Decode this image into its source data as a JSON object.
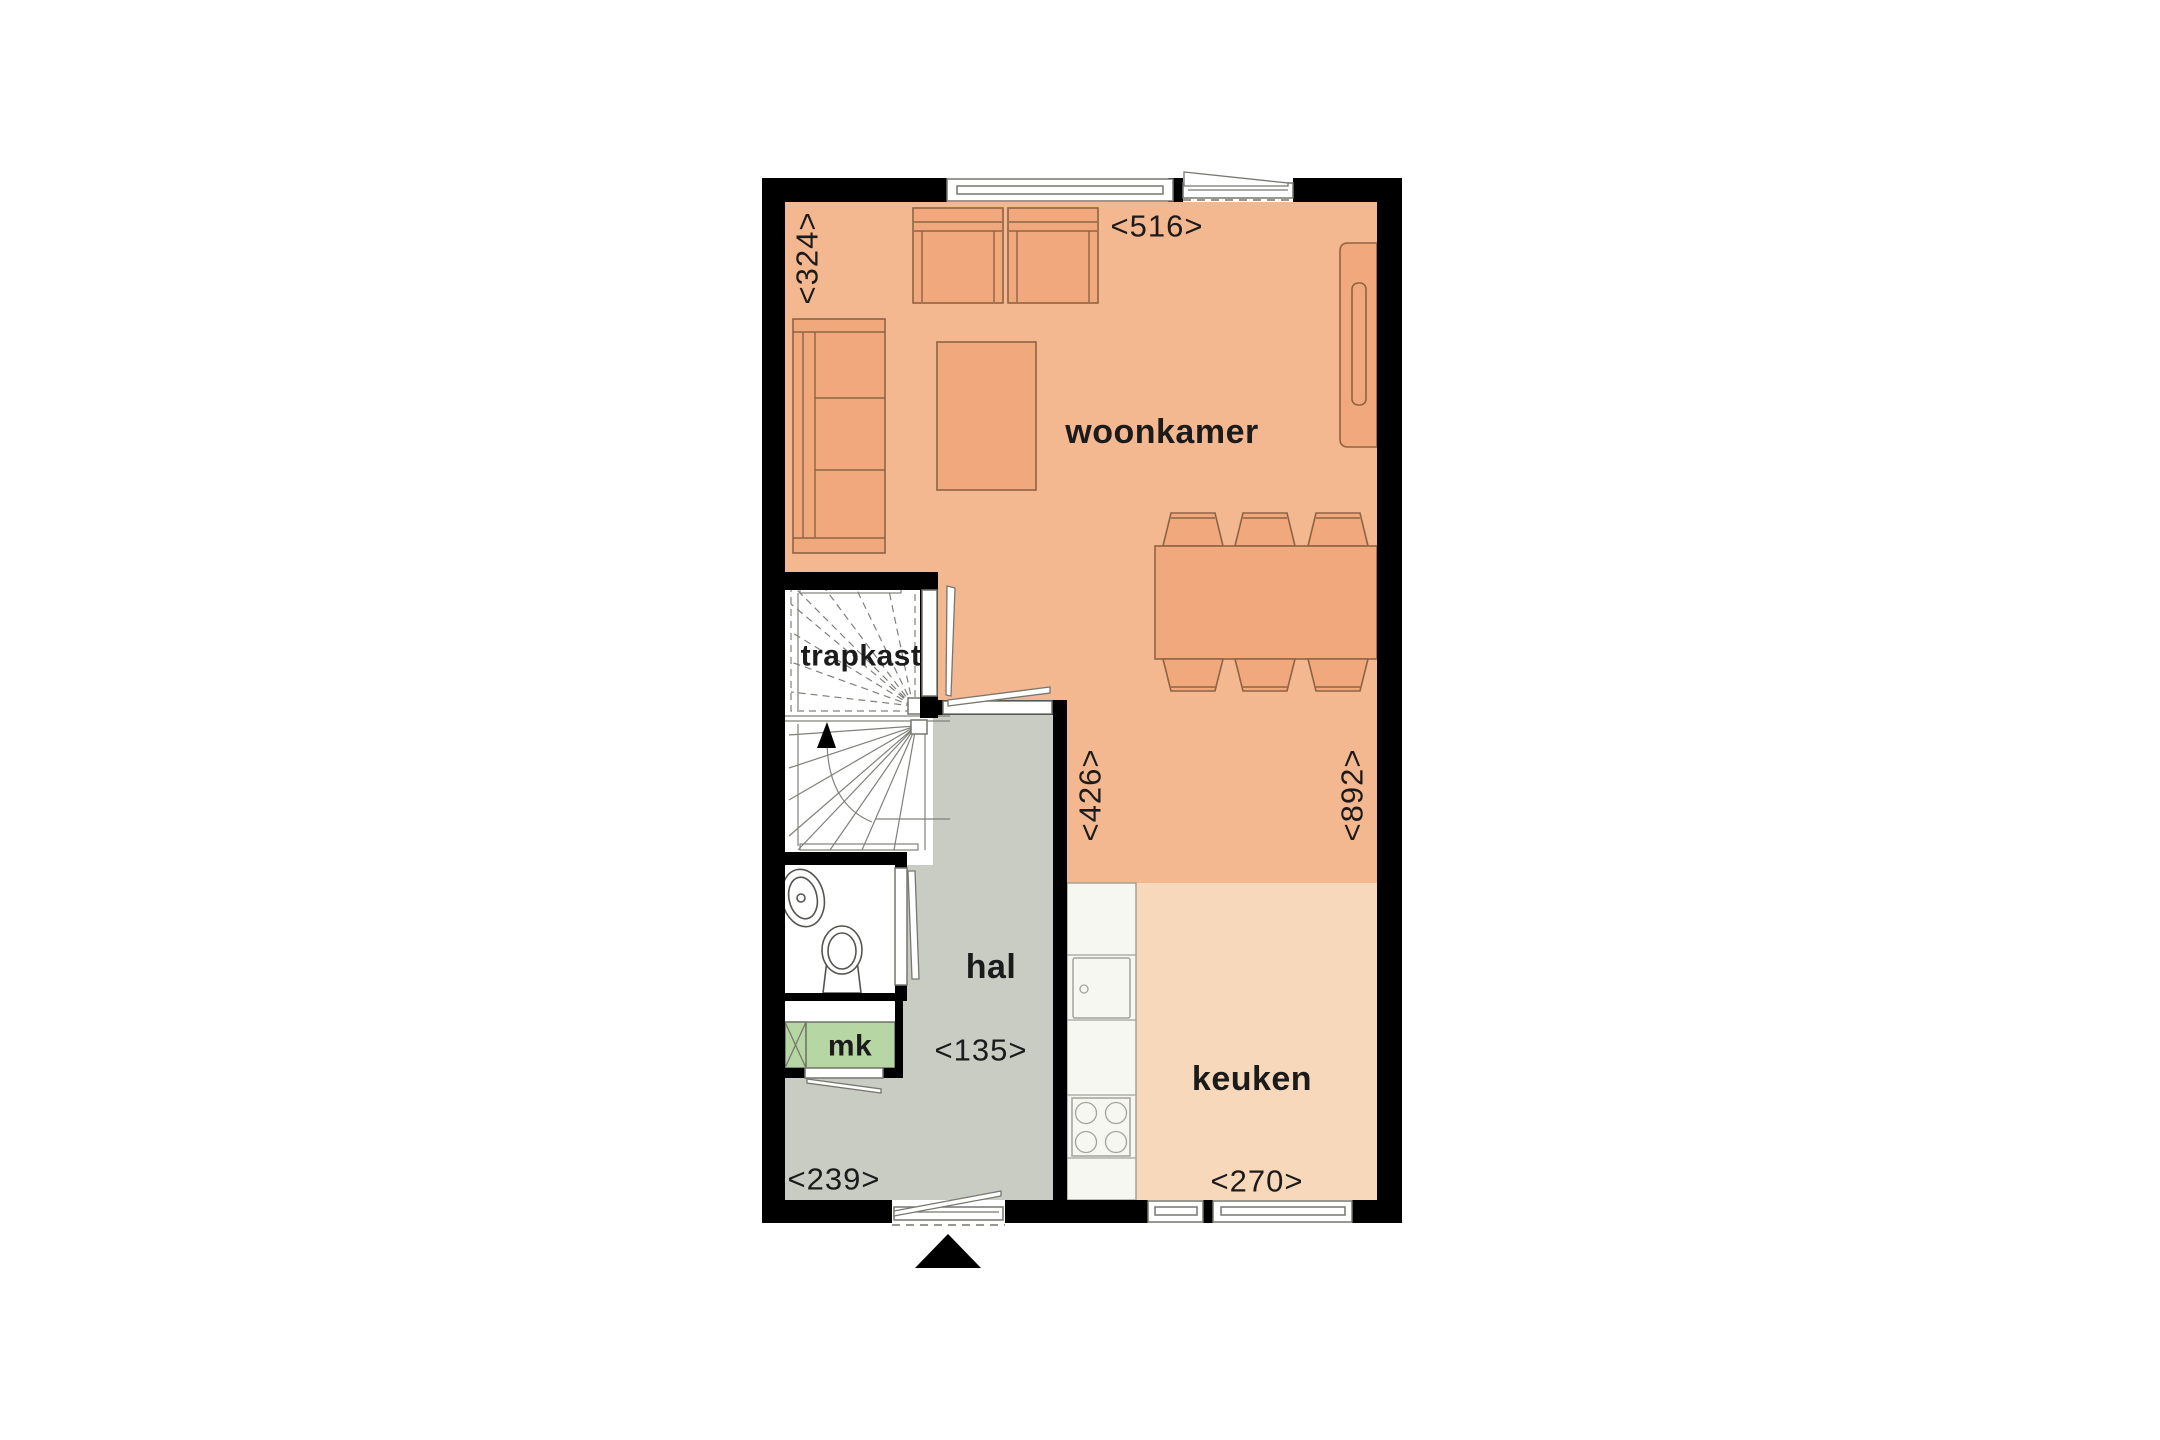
{
  "floorplan": {
    "room_labels": {
      "woonkamer": "woonkamer",
      "trapkast": "trapkast",
      "hal": "hal",
      "keuken": "keuken",
      "mk": "mk"
    },
    "dimension_labels": {
      "d324": "<324>",
      "d516": "<516>",
      "d426": "<426>",
      "d892": "<892>",
      "d135": "<135>",
      "d239": "<239>",
      "d270": "<270>"
    },
    "colors": {
      "wall": "#000000",
      "woonkamer_floor": "#f4b890",
      "keuken_floor": "#f8d8ba",
      "hal_floor": "#c9ccc3",
      "mk_fill": "#b6d7a3",
      "furniture_fill": "#f0a87c",
      "furniture_outline": "#8d6444",
      "counter_fill": "#f7f7f2",
      "label_text": "#1b1b1b"
    }
  }
}
